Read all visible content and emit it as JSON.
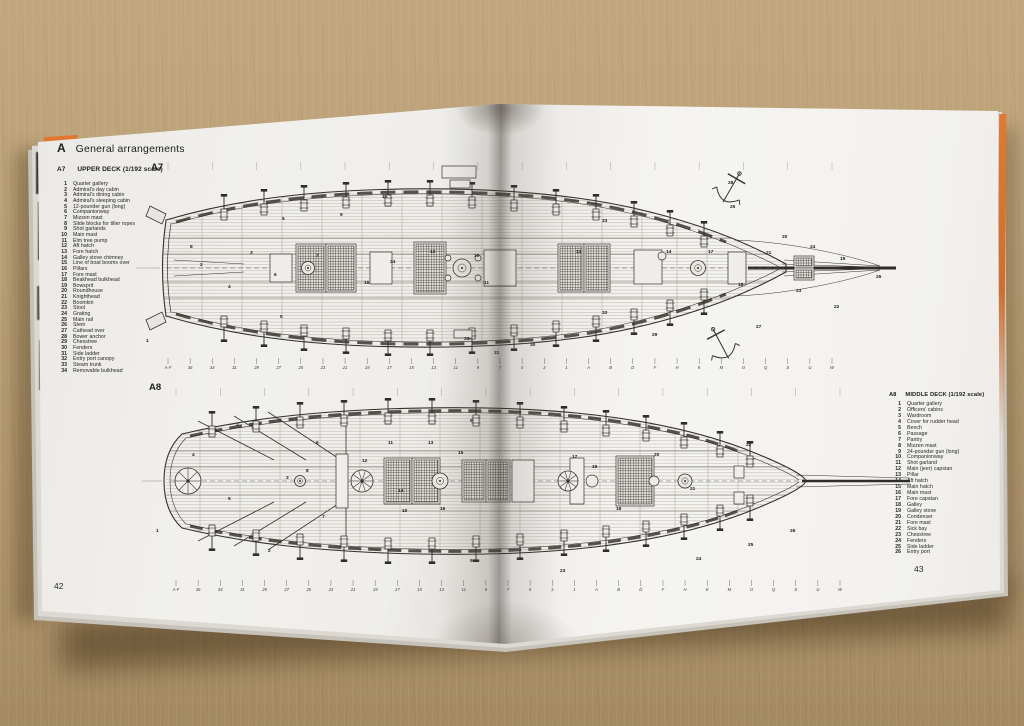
{
  "photo": {
    "surface": "cardboard",
    "surface_color": "#b49a72",
    "book_cover_color": "#e0762f",
    "page_color": "#f2f1ee"
  },
  "book": {
    "left_page_number": "42",
    "right_page_number": "43"
  },
  "header": {
    "section_letter": "A",
    "section_title": "General arrangements"
  },
  "plan_a7": {
    "figure_label": "A7",
    "code": "A7",
    "title": "UPPER DECK (1/192 scale)",
    "legend": [
      {
        "n": "1",
        "label": "Quarter gallery"
      },
      {
        "n": "2",
        "label": "Admiral's day cabin"
      },
      {
        "n": "3",
        "label": "Admiral's dining cabin"
      },
      {
        "n": "4",
        "label": "Admiral's sleeping cabin"
      },
      {
        "n": "5",
        "label": "12-pounder gun (long)"
      },
      {
        "n": "6",
        "label": "Companionway"
      },
      {
        "n": "7",
        "label": "Mizzen mast"
      },
      {
        "n": "8",
        "label": "Slide blocks for tiller ropes"
      },
      {
        "n": "9",
        "label": "Shot garlands"
      },
      {
        "n": "10",
        "label": "Main mast"
      },
      {
        "n": "11",
        "label": "Elm tree pump"
      },
      {
        "n": "12",
        "label": "Aft hatch"
      },
      {
        "n": "13",
        "label": "Fore hatch"
      },
      {
        "n": "14",
        "label": "Galley stove chimney"
      },
      {
        "n": "15",
        "label": "Line of boat booms over"
      },
      {
        "n": "16",
        "label": "Pillars"
      },
      {
        "n": "17",
        "label": "Fore mast"
      },
      {
        "n": "18",
        "label": "Beakhead bulkhead"
      },
      {
        "n": "19",
        "label": "Bowsprit"
      },
      {
        "n": "20",
        "label": "Roundhouse"
      },
      {
        "n": "21",
        "label": "Knighthead"
      },
      {
        "n": "22",
        "label": "Boomkin"
      },
      {
        "n": "23",
        "label": "Stool"
      },
      {
        "n": "24",
        "label": "Grating"
      },
      {
        "n": "25",
        "label": "Main rail"
      },
      {
        "n": "26",
        "label": "Stem"
      },
      {
        "n": "27",
        "label": "Cathead over"
      },
      {
        "n": "28",
        "label": "Bower anchor"
      },
      {
        "n": "29",
        "label": "Chesstree"
      },
      {
        "n": "30",
        "label": "Fenders"
      },
      {
        "n": "31",
        "label": "Side ladder"
      },
      {
        "n": "32",
        "label": "Entry port canopy"
      },
      {
        "n": "33",
        "label": "Steam trunk"
      },
      {
        "n": "34",
        "label": "Removable bulkhead"
      }
    ],
    "stations": [
      "A-F",
      "36",
      "34",
      "31",
      "29",
      "27",
      "25",
      "23",
      "21",
      "19",
      "17",
      "15",
      "13",
      "11",
      "9",
      "7",
      "5",
      "3",
      "1",
      "A",
      "B",
      "D",
      "F",
      "H",
      "K",
      "M",
      "O",
      "Q",
      "S",
      "U",
      "W"
    ],
    "callouts": [
      {
        "n": "1",
        "x": 14,
        "y": 182
      },
      {
        "n": "2",
        "x": 68,
        "y": 106
      },
      {
        "n": "3",
        "x": 118,
        "y": 94
      },
      {
        "n": "4",
        "x": 96,
        "y": 128
      },
      {
        "n": "5",
        "x": 150,
        "y": 60
      },
      {
        "n": "5",
        "x": 148,
        "y": 158
      },
      {
        "n": "6",
        "x": 142,
        "y": 116
      },
      {
        "n": "7",
        "x": 184,
        "y": 97
      },
      {
        "n": "8",
        "x": 58,
        "y": 88
      },
      {
        "n": "9",
        "x": 208,
        "y": 56
      },
      {
        "n": "10",
        "x": 342,
        "y": 97
      },
      {
        "n": "11",
        "x": 352,
        "y": 124
      },
      {
        "n": "12",
        "x": 298,
        "y": 93
      },
      {
        "n": "13",
        "x": 444,
        "y": 93
      },
      {
        "n": "14",
        "x": 534,
        "y": 93
      },
      {
        "n": "15",
        "x": 250,
        "y": 38
      },
      {
        "n": "16",
        "x": 232,
        "y": 124
      },
      {
        "n": "17",
        "x": 576,
        "y": 93
      },
      {
        "n": "18",
        "x": 606,
        "y": 126
      },
      {
        "n": "19",
        "x": 708,
        "y": 100
      },
      {
        "n": "20",
        "x": 650,
        "y": 78
      },
      {
        "n": "21",
        "x": 634,
        "y": 94
      },
      {
        "n": "22",
        "x": 702,
        "y": 148
      },
      {
        "n": "23",
        "x": 664,
        "y": 132
      },
      {
        "n": "24",
        "x": 678,
        "y": 88
      },
      {
        "n": "25",
        "x": 598,
        "y": 48
      },
      {
        "n": "26",
        "x": 744,
        "y": 118
      },
      {
        "n": "27",
        "x": 624,
        "y": 168
      },
      {
        "n": "28",
        "x": 596,
        "y": 24
      },
      {
        "n": "29",
        "x": 520,
        "y": 176
      },
      {
        "n": "30",
        "x": 398,
        "y": 186
      },
      {
        "n": "31",
        "x": 362,
        "y": 194
      },
      {
        "n": "32",
        "x": 332,
        "y": 180
      },
      {
        "n": "33",
        "x": 470,
        "y": 62
      },
      {
        "n": "33",
        "x": 470,
        "y": 154
      },
      {
        "n": "34",
        "x": 258,
        "y": 103
      }
    ]
  },
  "plan_a8": {
    "figure_label": "A8",
    "code": "A8",
    "title": "MIDDLE DECK (1/192 scale)",
    "legend": [
      {
        "n": "1",
        "label": "Quarter gallery"
      },
      {
        "n": "2",
        "label": "Officers' cabins"
      },
      {
        "n": "3",
        "label": "Wardroom"
      },
      {
        "n": "4",
        "label": "Cover for rudder head"
      },
      {
        "n": "5",
        "label": "Bench"
      },
      {
        "n": "6",
        "label": "Passage"
      },
      {
        "n": "7",
        "label": "Pantry"
      },
      {
        "n": "8",
        "label": "Mizzen mast"
      },
      {
        "n": "9",
        "label": "24-pounder gun (long)"
      },
      {
        "n": "10",
        "label": "Companionway"
      },
      {
        "n": "11",
        "label": "Shot garland"
      },
      {
        "n": "12",
        "label": "Main (jeer) capstan"
      },
      {
        "n": "13",
        "label": "Pillar"
      },
      {
        "n": "14",
        "label": "Aft hatch"
      },
      {
        "n": "15",
        "label": "Main hatch"
      },
      {
        "n": "16",
        "label": "Main mast"
      },
      {
        "n": "17",
        "label": "Fore capstan"
      },
      {
        "n": "18",
        "label": "Galley"
      },
      {
        "n": "19",
        "label": "Galley stove"
      },
      {
        "n": "20",
        "label": "Condenser"
      },
      {
        "n": "21",
        "label": "Fore mast"
      },
      {
        "n": "22",
        "label": "Sick bay"
      },
      {
        "n": "23",
        "label": "Chesstree"
      },
      {
        "n": "24",
        "label": "Fenders"
      },
      {
        "n": "25",
        "label": "Side ladder"
      },
      {
        "n": "26",
        "label": "Entry port"
      }
    ],
    "stations": [
      "A-F",
      "36",
      "34",
      "31",
      "29",
      "27",
      "25",
      "23",
      "21",
      "19",
      "17",
      "15",
      "13",
      "11",
      "9",
      "7",
      "5",
      "3",
      "1",
      "A",
      "B",
      "D",
      "F",
      "H",
      "K",
      "M",
      "O",
      "Q",
      "S",
      "U",
      "W"
    ],
    "callouts": [
      {
        "n": "1",
        "x": 16,
        "y": 144
      },
      {
        "n": "2",
        "x": 96,
        "y": 38
      },
      {
        "n": "2",
        "x": 128,
        "y": 164
      },
      {
        "n": "3",
        "x": 146,
        "y": 91
      },
      {
        "n": "4",
        "x": 52,
        "y": 68
      },
      {
        "n": "5",
        "x": 88,
        "y": 112
      },
      {
        "n": "6",
        "x": 176,
        "y": 56
      },
      {
        "n": "7",
        "x": 182,
        "y": 130
      },
      {
        "n": "8",
        "x": 166,
        "y": 84
      },
      {
        "n": "9",
        "x": 330,
        "y": 34
      },
      {
        "n": "9",
        "x": 330,
        "y": 174
      },
      {
        "n": "10",
        "x": 262,
        "y": 124
      },
      {
        "n": "11",
        "x": 248,
        "y": 56
      },
      {
        "n": "12",
        "x": 222,
        "y": 74
      },
      {
        "n": "13",
        "x": 288,
        "y": 56
      },
      {
        "n": "14",
        "x": 258,
        "y": 104
      },
      {
        "n": "15",
        "x": 318,
        "y": 66
      },
      {
        "n": "16",
        "x": 300,
        "y": 122
      },
      {
        "n": "17",
        "x": 432,
        "y": 70
      },
      {
        "n": "18",
        "x": 476,
        "y": 122
      },
      {
        "n": "19",
        "x": 452,
        "y": 80
      },
      {
        "n": "20",
        "x": 514,
        "y": 68
      },
      {
        "n": "21",
        "x": 550,
        "y": 102
      },
      {
        "n": "22",
        "x": 606,
        "y": 58
      },
      {
        "n": "23",
        "x": 420,
        "y": 184
      },
      {
        "n": "24",
        "x": 556,
        "y": 172
      },
      {
        "n": "25",
        "x": 608,
        "y": 158
      },
      {
        "n": "26",
        "x": 650,
        "y": 144
      }
    ]
  }
}
